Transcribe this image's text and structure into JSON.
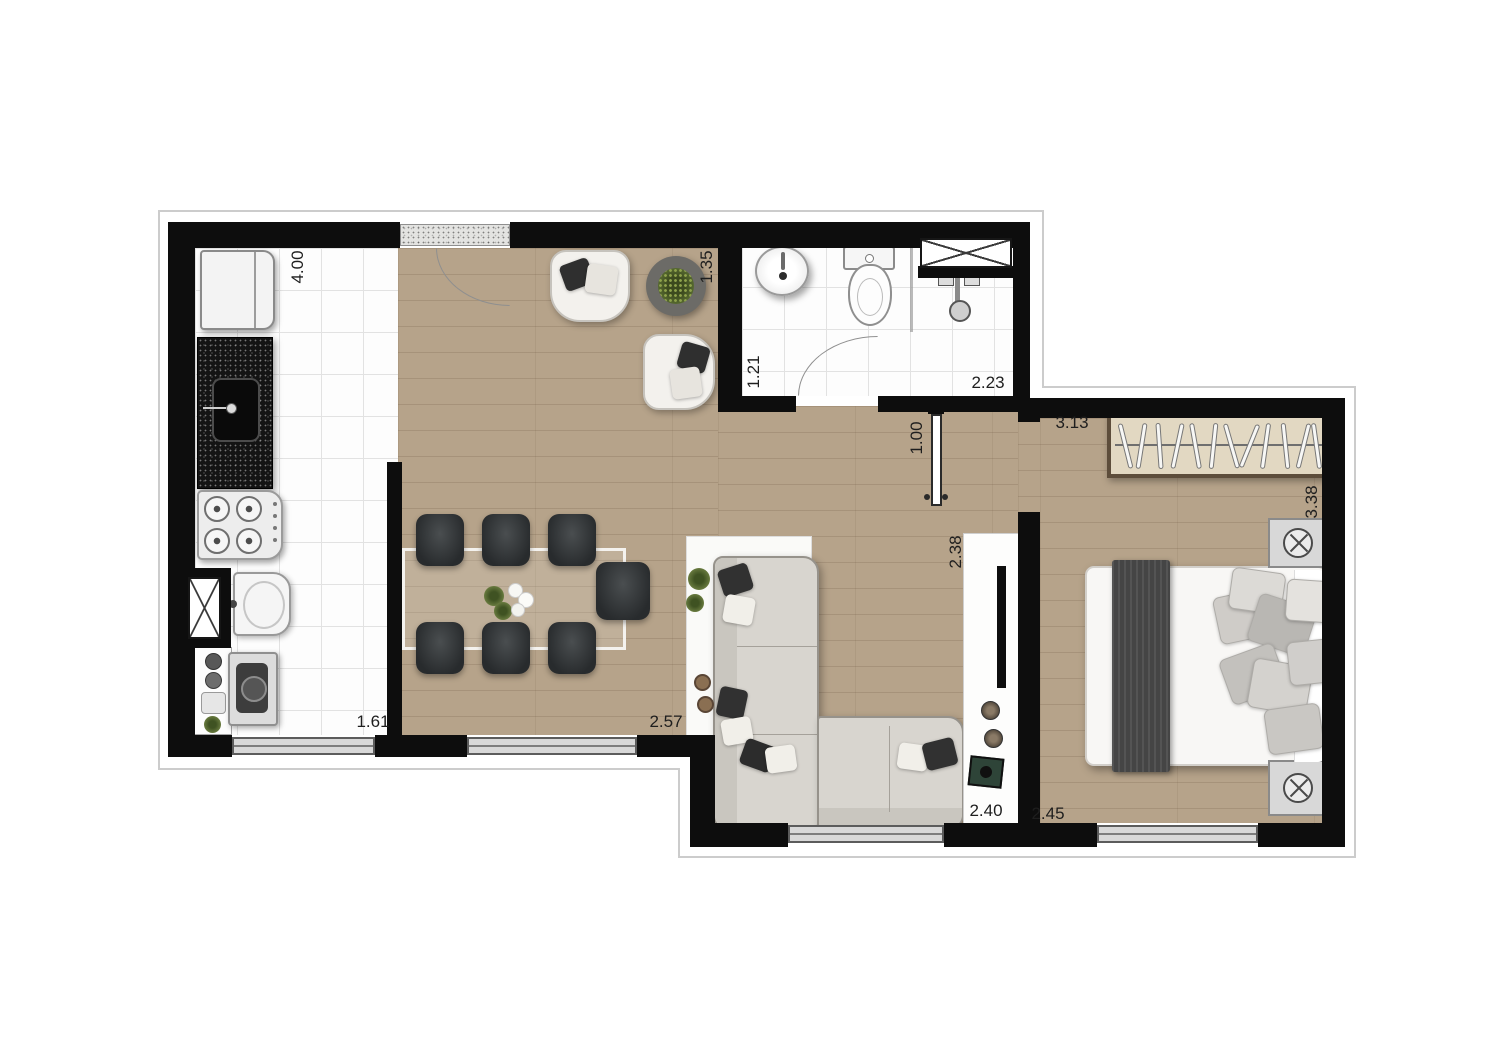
{
  "plan": {
    "type": "residential-floor-plan",
    "unit": "m",
    "colors": {
      "wall": "#0d0d0d",
      "wood_floor": "#b6a38a",
      "tile_floor": "#fdfdfd",
      "granite_counter": "#141414",
      "window_frame": "#5c5c5c",
      "wardrobe_border": "#5d4d3b"
    },
    "rooms": [
      "kitchen",
      "living-dining",
      "bathroom",
      "hall",
      "bedroom"
    ],
    "furniture": [
      "refrigerator",
      "granite-counter-with-sink",
      "cooktop",
      "laundry-tank",
      "washing-machine",
      "storage-shelf",
      "oven",
      "dining-table",
      "dining-chair",
      "flower-centerpiece",
      "armchair",
      "round-side-table",
      "potted-plant",
      "area-rug",
      "corner-sofa",
      "tv-panel",
      "speakers",
      "magazine",
      "washbasin",
      "toilet",
      "shower",
      "glass-partition",
      "wall-shaft",
      "wardrobe",
      "double-bed",
      "bed-runner",
      "nightstand",
      "table-lamp",
      "window",
      "entry-door"
    ],
    "dimensions": {
      "kitchen_side": "4.00",
      "living_entry_side": "1.35",
      "bathroom_side": "1.21",
      "bathroom_width": "2.23",
      "hall_width": "1.00",
      "bedroom_width": "3.13",
      "bedroom_depth": "3.38",
      "living_tv_side": "2.38",
      "kitchen_window": "1.61",
      "dining_window": "2.57",
      "living_window": "2.40",
      "bedroom_window": "2.45"
    }
  }
}
